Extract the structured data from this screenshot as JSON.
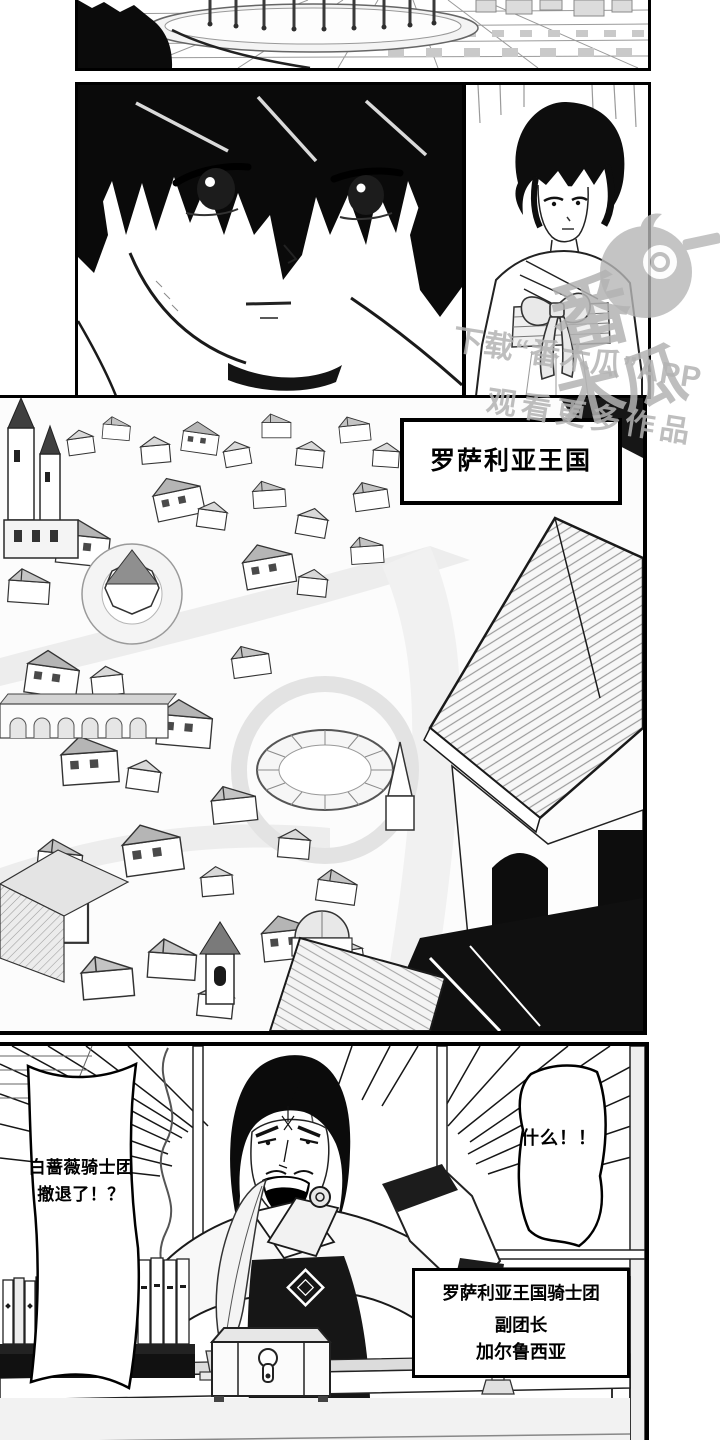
{
  "city": {
    "caption": "罗萨利亚王国"
  },
  "office": {
    "left_bubble": {
      "line1": "白蔷薇骑士团",
      "line2": "撤退了！？"
    },
    "right_bubble": {
      "text": "什么！！"
    },
    "caption": {
      "line1": "罗萨利亚王国骑士团",
      "line2": "副团长",
      "line3": "加尔鲁西亚"
    }
  },
  "watermark": {
    "logo_top": "番",
    "logo_bottom": "木瓜",
    "line1": "下载“番木瓜”APP",
    "line2": "观看更多作品"
  },
  "colors": {
    "ink": "#000000",
    "paper": "#ffffff",
    "watermark_gray": "#b3b3b3"
  }
}
